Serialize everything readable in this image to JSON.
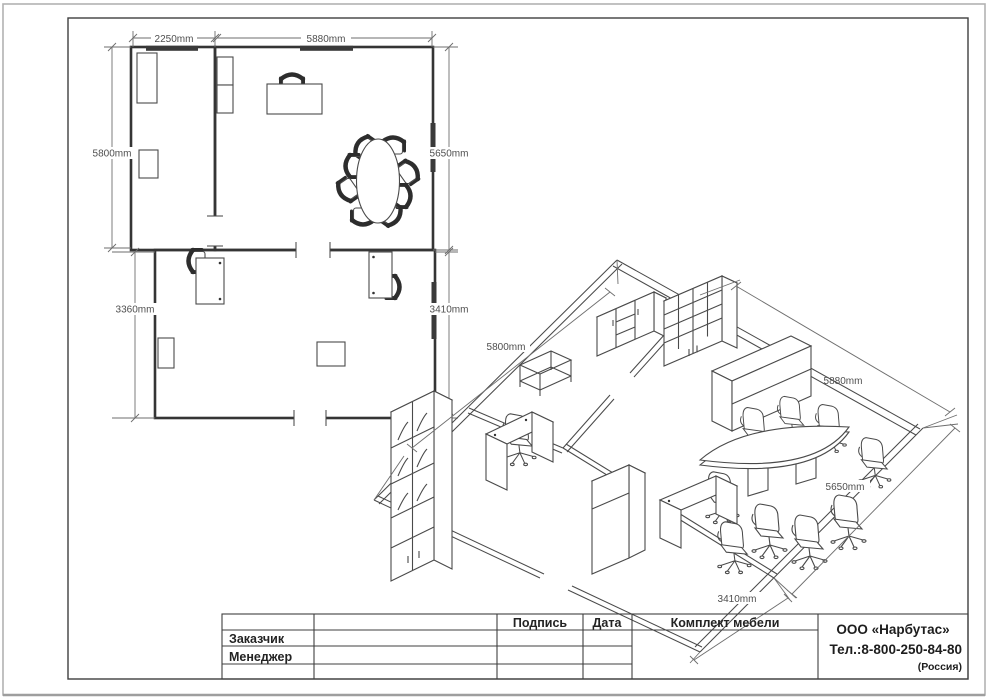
{
  "drawing": {
    "floor_plan": {
      "dim_top_left": "2250mm",
      "dim_top_main": "5880mm",
      "dim_left": "5800mm",
      "dim_right": "5650mm",
      "dim_bottom_left": "3360mm",
      "dim_bottom_right": "3410mm"
    },
    "iso_view": {
      "dim_left_wall": "5800mm",
      "dim_far_wall": "5880mm",
      "dim_right_wall": "5650mm",
      "dim_near_wall": "3410mm"
    },
    "title_block": {
      "col_signature": "Подпись",
      "col_date": "Дата",
      "project_title": "Комплект мебели",
      "row_customer": "Заказчик",
      "row_manager": "Менеджер",
      "company_name": "ООО «Нарбутас»",
      "company_phone": "Тел.:8-800-250-84-80",
      "company_country": "(Россия)"
    },
    "colors": {
      "wall": "#353535",
      "furniture_line": "#4a4a4a",
      "dimension_line": "#6e6e6e",
      "window_fill": "#3a3a3a"
    }
  }
}
